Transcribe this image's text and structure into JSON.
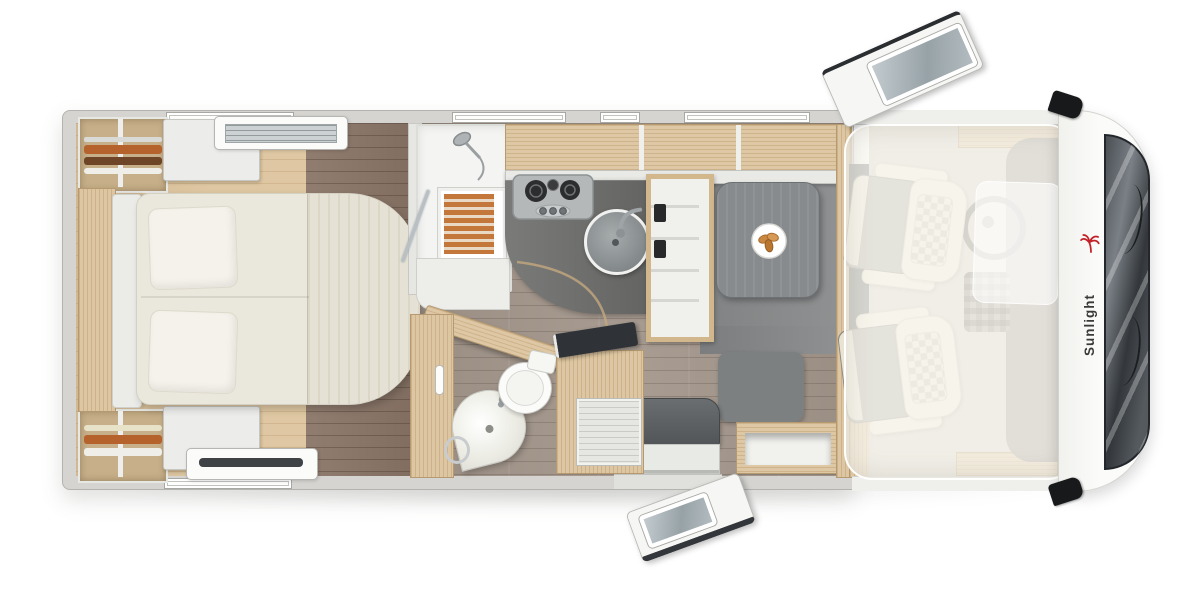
{
  "meta": {
    "title": "Motorhome top-view floor plan render"
  },
  "brand": {
    "logo_text": "Sunlight"
  },
  "icons": {
    "brand": "palm-tree-icon",
    "shower": "shower-head-icon",
    "cooking": "gas-hob-icon",
    "washing": "sink-faucet-icon",
    "dining": "plate-food-icon",
    "driving": "steering-wheel-icon",
    "front": "windshield-wiper-icon",
    "exterior": "side-mirror-icon"
  },
  "colors": {
    "background": "#ffffff",
    "wall": "#d5d4d1",
    "wall_edge": "#b4b3b0",
    "white_furniture": "#ececea",
    "wood": "#dac19a",
    "floor_bedroom": "#dcc39b",
    "floor_walnut": "#8b7668",
    "floor_living": "#a3968b",
    "floor_dinette": "#898b8c",
    "counter": "#6f706e",
    "table": "#888b8d",
    "bed": "#eae7dc",
    "pillow": "#f4f2ea",
    "seat_cream": "#ece6d7",
    "seat_check": "#c8c1ae",
    "bench_gray": "#7d8081",
    "seat_dark": "#5d6063",
    "teak": "#c3773a",
    "steel": "#b5b8b9",
    "windshield": "#3c4145",
    "vent": "#ccd2d3",
    "brand_red": "#c32127",
    "logo_text": "#3a3a3a"
  }
}
